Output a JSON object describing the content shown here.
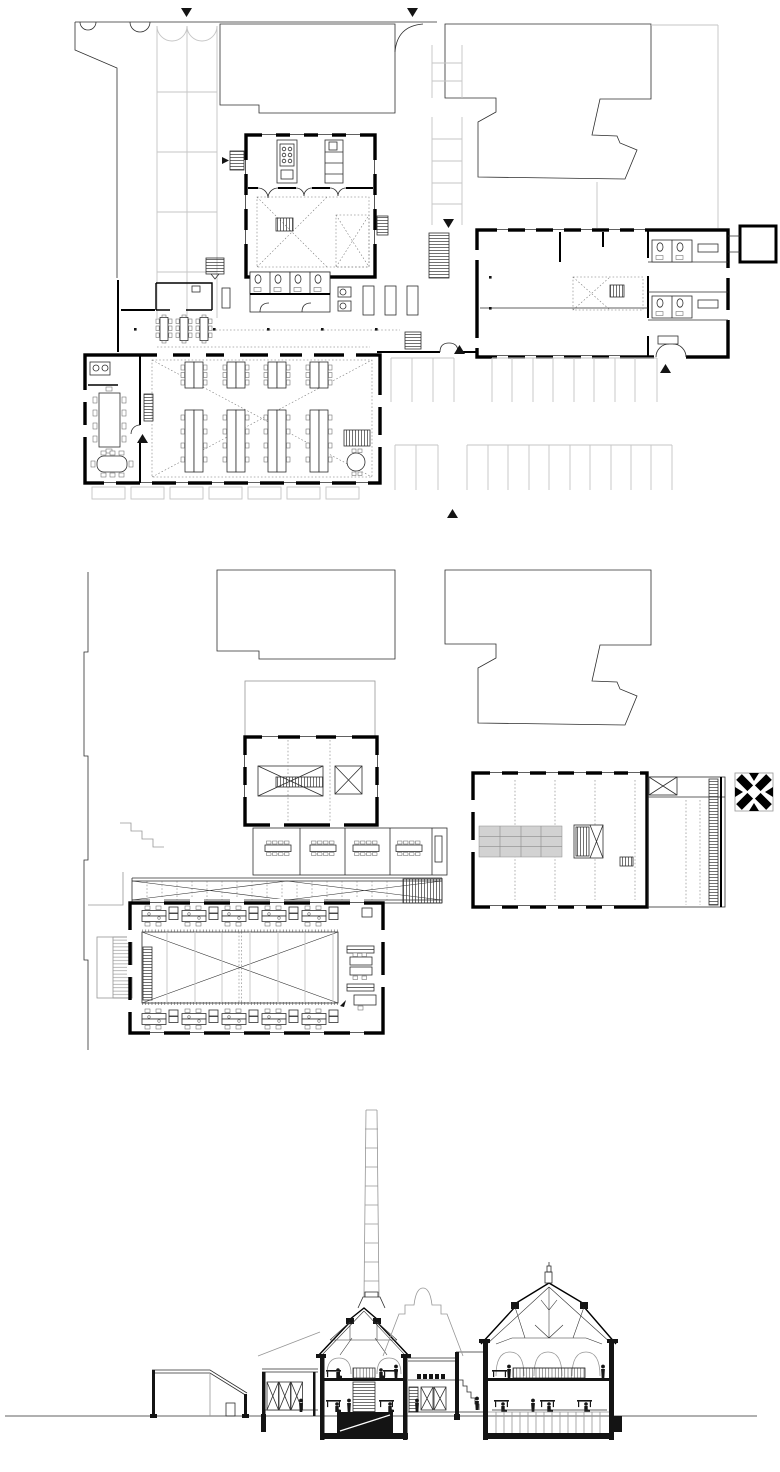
{
  "canvas": {
    "width": 780,
    "height": 1472,
    "background": "#ffffff"
  },
  "palette": {
    "wall_ink": "#000000",
    "line_ink": "#2e2e2e",
    "context_gray": "#969696",
    "faint_gray": "#c5c5c5",
    "panel_gray": "#d2d2d2",
    "figure_ink": "#161616"
  },
  "visible_text": [],
  "drawings": [
    {
      "id": "ground-floor-plan",
      "aria": "Ground floor plan with site context, parking stalls, canteen, toilets and open office desks"
    },
    {
      "id": "upper-floor-plan",
      "aria": "Upper floor plan with braced voids, meeting rooms, connecting bridge and cross logo"
    },
    {
      "id": "cross-section",
      "aria": "Cross section through the halls with tall chimney, roof trusses, desks and human figures"
    }
  ],
  "icons": {
    "marker-down": "▼",
    "marker-up": "▲",
    "entry-arrow": "►",
    "cross-logo": "✕"
  },
  "counts": {
    "ground_floor": {
      "open_office_desk_groups": 8,
      "canteen_tables": 3,
      "corridor_tables": 3,
      "wc_stall_groups": 4,
      "parking_stalls": 24,
      "orientation_markers": 6
    },
    "upper_floor": {
      "meeting_rooms": 4,
      "perimeter_desk_groups": 10,
      "storage_grid_bays": 12,
      "braced_voids": 4
    },
    "section": {
      "figures": 15,
      "chimney_segments": 10
    }
  }
}
